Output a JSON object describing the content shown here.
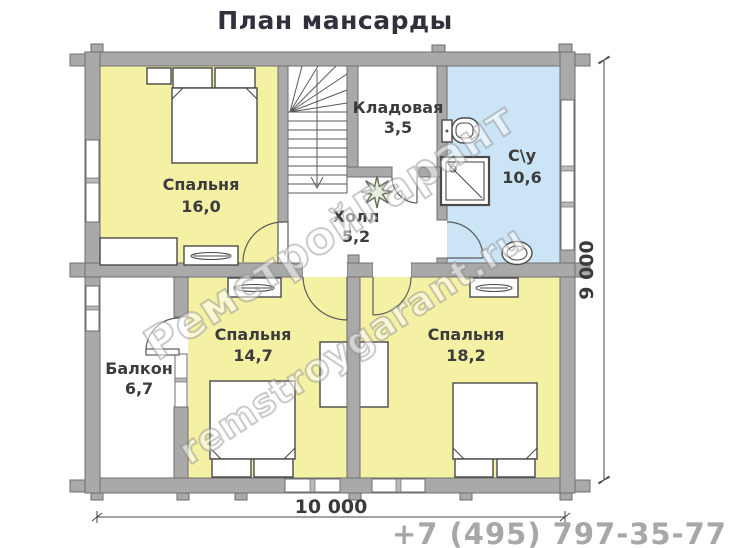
{
  "title": "План мансарды",
  "phone": "+7 (495) 797-35-77",
  "watermark": {
    "brand": "РемстройГарант",
    "site": "remstroygarant.ru"
  },
  "rooms": {
    "bedroom_top": {
      "name": "Спальня",
      "area": "16,0"
    },
    "storage": {
      "name": "Кладовая",
      "area": "3,5"
    },
    "bathroom": {
      "name": "С\\у",
      "area": "10,6"
    },
    "hall": {
      "name": "Холл",
      "area": "5,2"
    },
    "balcony": {
      "name": "Балкон",
      "area": "6,7"
    },
    "bedroom_left": {
      "name": "Спальня",
      "area": "14,7"
    },
    "bedroom_right": {
      "name": "Спальня",
      "area": "18,2"
    }
  },
  "dimensions": {
    "width_label": "10 000",
    "height_label": "9 000"
  },
  "colors": {
    "room_yellow": "#f4f0a4",
    "room_blue": "#cbe4f6",
    "wall_gray": "#a9a9a9",
    "wall_stroke": "#6e6e6e",
    "label_text": "#3c3c3c",
    "phone_gray": "#a7a7a7"
  }
}
